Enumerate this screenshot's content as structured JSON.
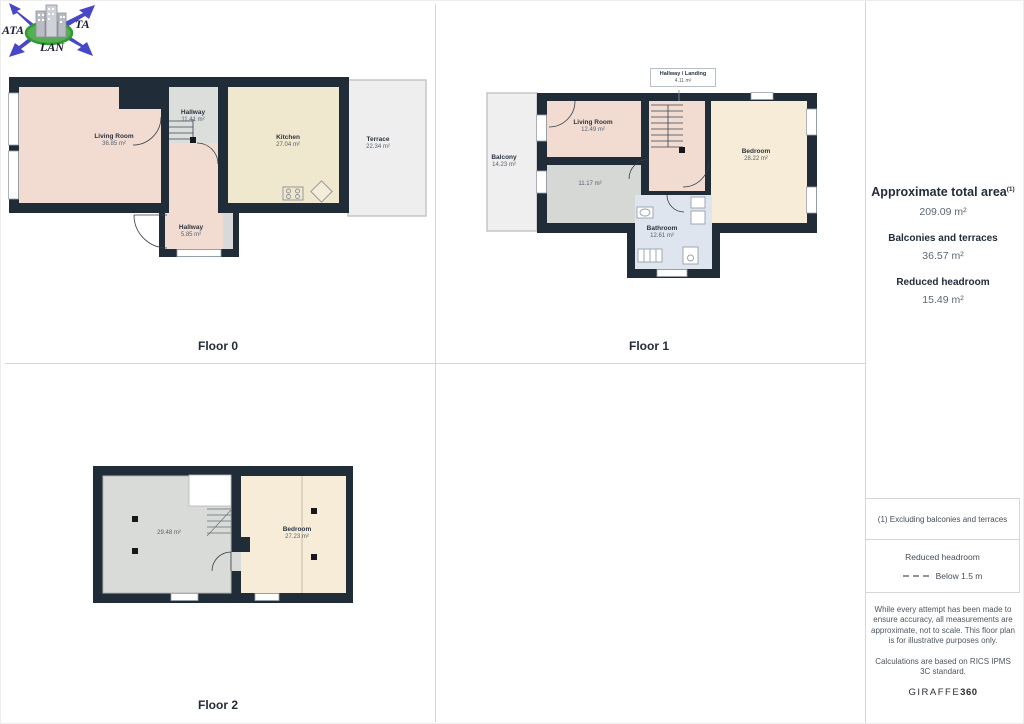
{
  "logo": {
    "text_left": "ATA",
    "text_right": "TA",
    "text_bottom": "LAN"
  },
  "floors": {
    "floor0": {
      "label": "Floor 0",
      "rooms": [
        {
          "name": "Living Room",
          "area": "36.85 m²"
        },
        {
          "name": "Hallway",
          "area": "11.41 m²"
        },
        {
          "name": "Kitchen",
          "area": "27.04 m²"
        },
        {
          "name": "Terrace",
          "area": "22.34 m²"
        },
        {
          "name": "Hallway",
          "area": "5.85 m²"
        }
      ]
    },
    "floor1": {
      "label": "Floor 1",
      "rooms": [
        {
          "name": "Hallway / Landing",
          "area": "4.11 m²"
        },
        {
          "name": "Balcony",
          "area": "14.23 m²"
        },
        {
          "name": "Living Room",
          "area": "12.49 m²"
        },
        {
          "name": "",
          "area": "11.17 m²"
        },
        {
          "name": "Bedroom",
          "area": "28.22 m²"
        },
        {
          "name": "Bathroom",
          "area": "12.61 m²"
        }
      ]
    },
    "floor2": {
      "label": "Floor 2",
      "rooms": [
        {
          "name": "",
          "area": "29.48 m²"
        },
        {
          "name": "Bedroom",
          "area": "27.23 m²"
        }
      ]
    }
  },
  "sidebar": {
    "total_area_label": "Approximate total area",
    "total_area_sup": "(1)",
    "total_area_value": "209.09 m²",
    "balconies_label": "Balconies and terraces",
    "balconies_value": "36.57 m²",
    "reduced_label": "Reduced headroom",
    "reduced_value": "15.49 m²",
    "footnote": "(1) Excluding balconies and terraces",
    "legend_title": "Reduced headroom",
    "legend_value": "Below 1.5 m",
    "disclaimer1": "While every attempt has been made to ensure accuracy, all measurements are approximate, not to scale. This floor plan is for illustrative purposes only.",
    "disclaimer2": "Calculations are based on RICS IPMS 3C standard.",
    "brand": "GIRAFFE",
    "brand_bold": "360"
  },
  "colors": {
    "wall": "#212c39",
    "room_peach": "#f2dcd2",
    "room_cream": "#f7ecd8",
    "kitchen_cream": "#f0e7cf",
    "room_gray": "#d6d8d5",
    "outdoor_gray": "#eeeeee",
    "bathroom_blue": "#dfe5ee",
    "logo_blue": "#4747c7",
    "logo_green": "#2f9b2f",
    "text_navy": "#232d3a",
    "text_gray": "#5d6773"
  }
}
